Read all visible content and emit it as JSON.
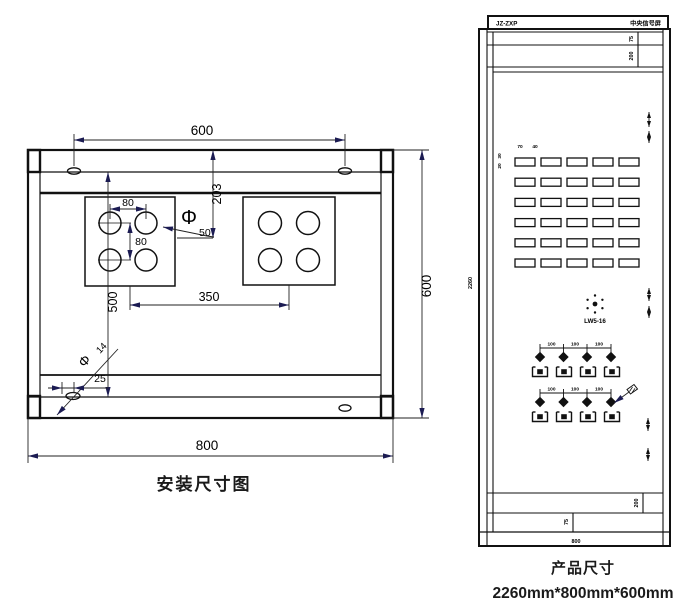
{
  "installation": {
    "caption": "安装尺寸图",
    "dim_top_width": "600",
    "dim_offset_203": "203",
    "dim_hole_pitch_h": "80",
    "dim_hole_pitch_v": "80",
    "hole_dia_symbol": "Φ",
    "hole_dia": "50",
    "dim_left_height": "500",
    "dim_plate_pitch": "350",
    "slot_dia_symbol": "Φ",
    "slot_dia": "14",
    "dim_slot_offset": "25",
    "dim_bottom_width": "800",
    "dim_right_height": "600"
  },
  "product": {
    "caption": "产品尺寸",
    "overall_size": "2260mm*800mm*600mm",
    "nameplate_model": "JZ-ZXP",
    "nameplate_title": "中央信号屏",
    "dim_height": "2260",
    "dim_top_trim": "75",
    "dim_top_panel": "200",
    "dim_bottom_panel": "200",
    "dim_bottom_trim": "75",
    "dim_width": "800",
    "window_pitch_h": "70",
    "window_width": "40",
    "window_pitch_v": "30",
    "window_height": "20",
    "window_grid": {
      "rows": 6,
      "cols": 5
    },
    "switch_label": "LW5-16",
    "lamp_pitch": "100",
    "lamp_rows": 2,
    "lamps_per_row": 4
  }
}
